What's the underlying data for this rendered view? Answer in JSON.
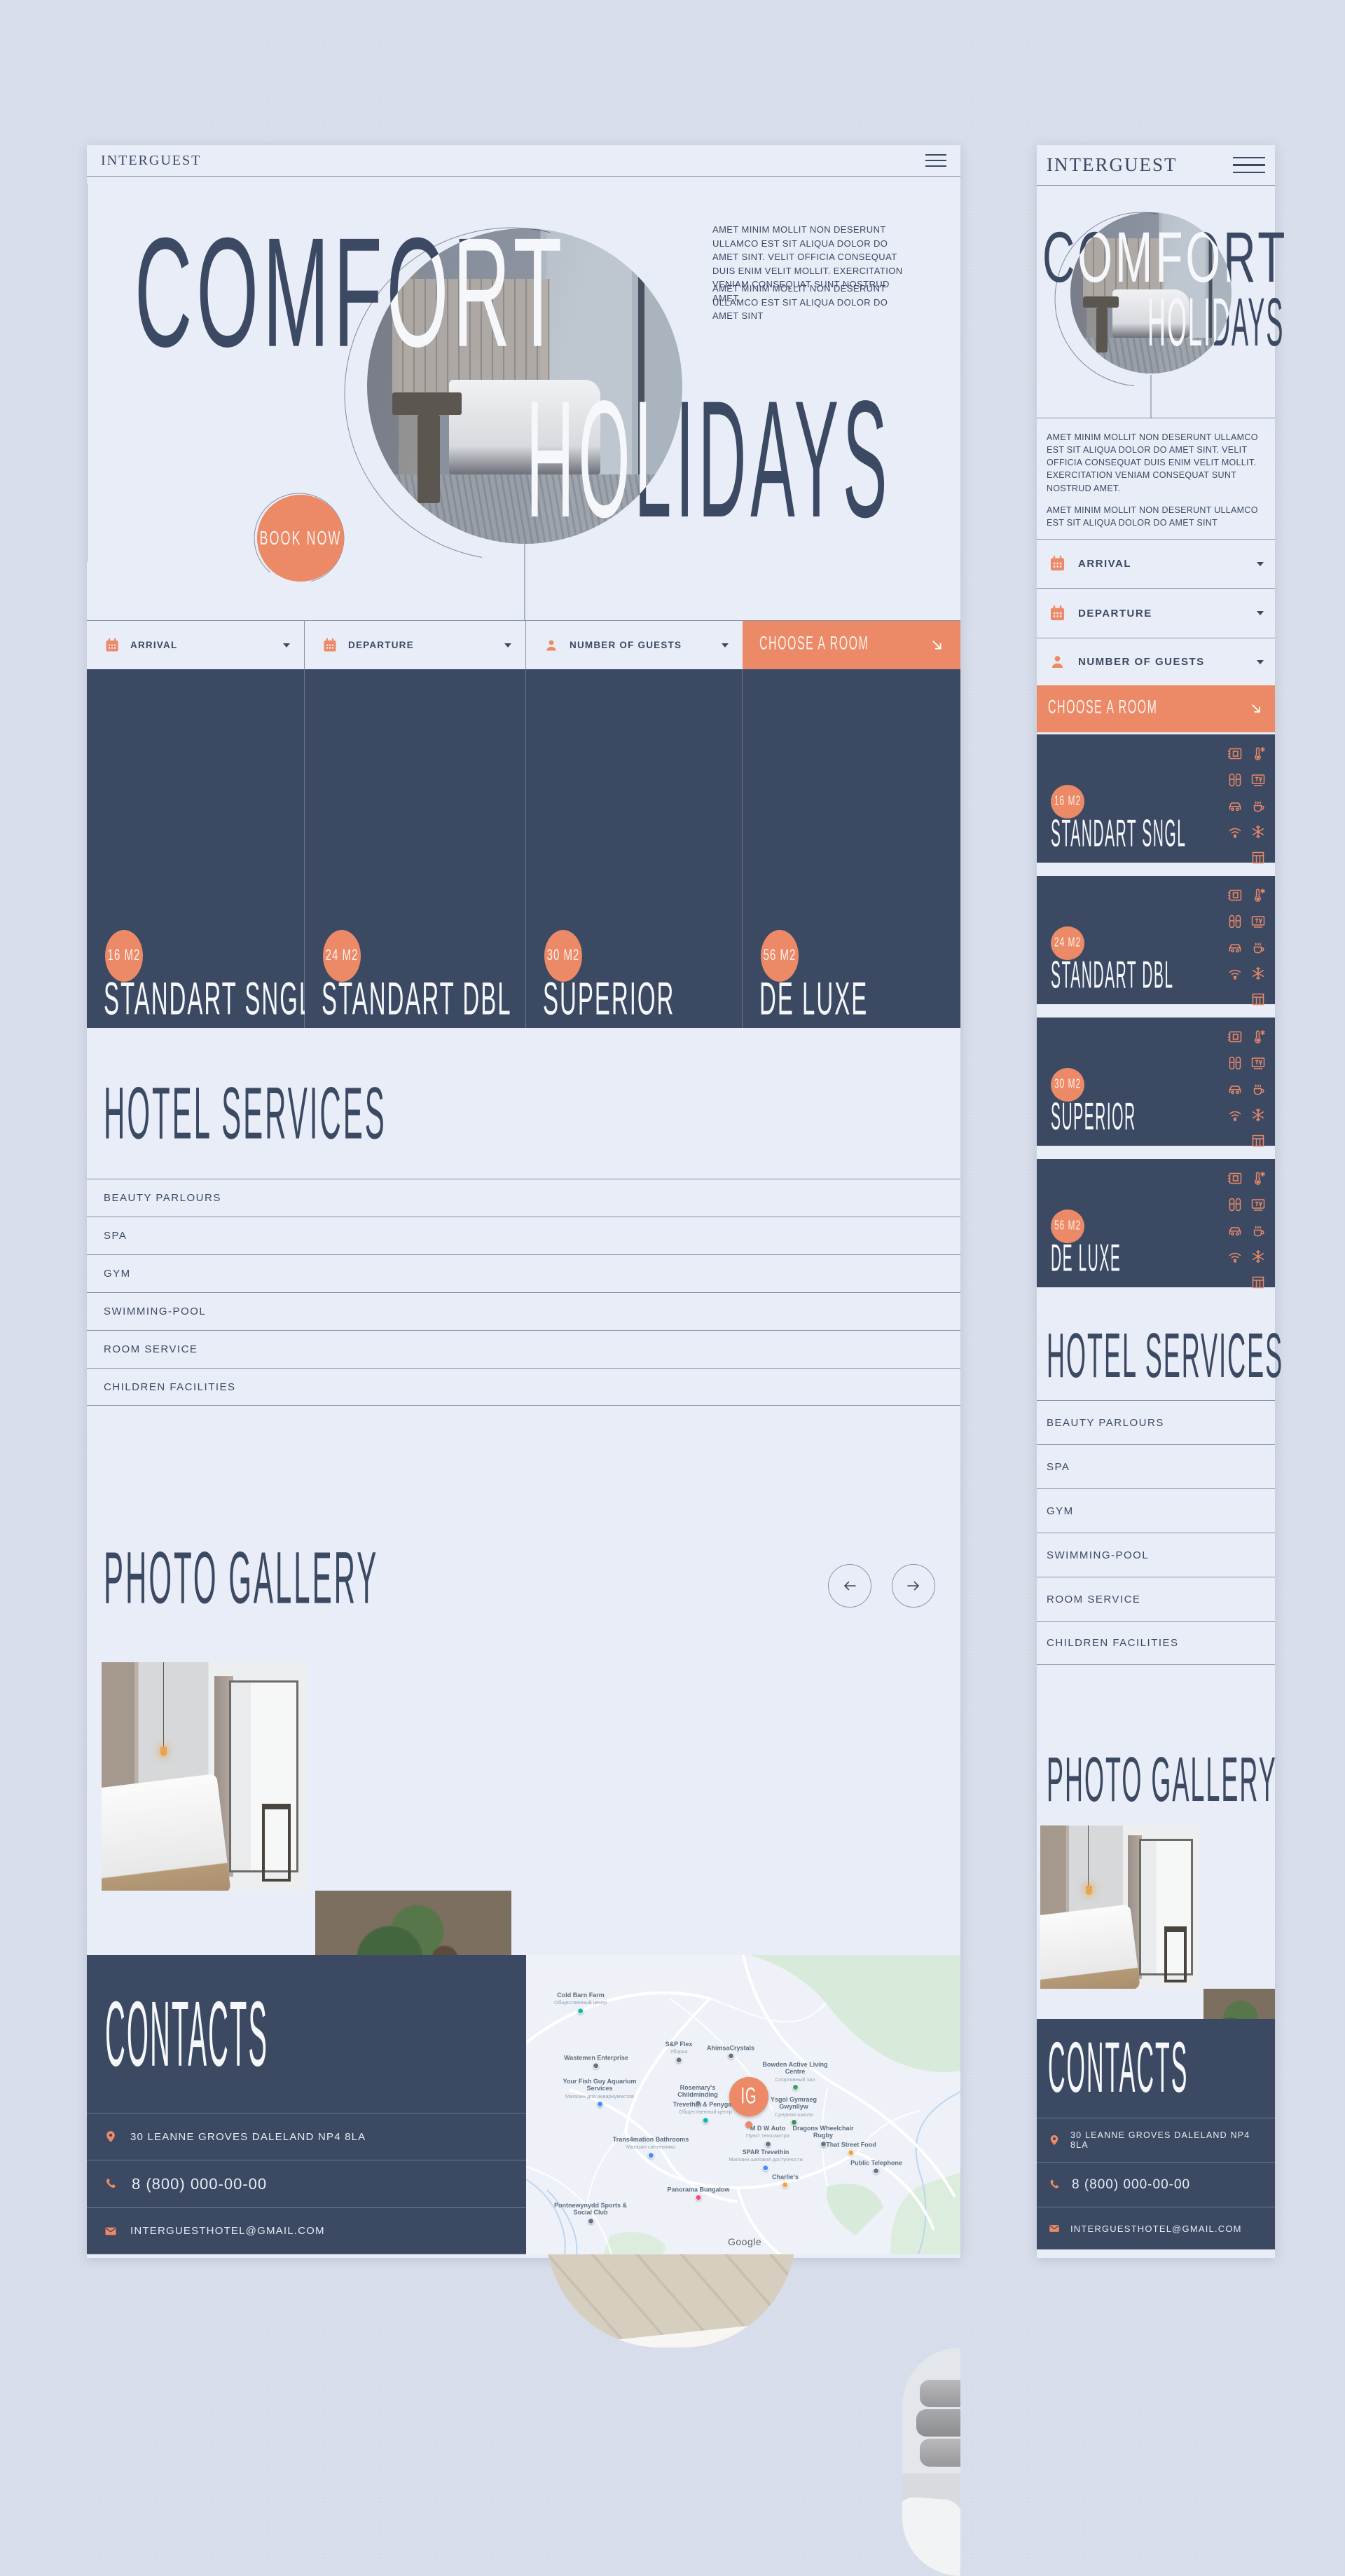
{
  "brand": "INTERGUEST",
  "hero": {
    "word1": "COMFORT",
    "word2": "HOLIDAYS",
    "cta": "BOOK NOW",
    "p1": "AMET MINIM MOLLIT NON DESERUNT ULLAMCO EST SIT ALIQUA DOLOR DO AMET SINT. VELIT OFFICIA CONSEQUAT DUIS ENIM VELIT MOLLIT. EXERCITATION VENIAM CONSEQUAT SUNT NOSTRUD AMET.",
    "p2": "AMET MINIM MOLLIT NON DESERUNT ULLAMCO EST SIT ALIQUA DOLOR DO AMET SINT"
  },
  "booking": {
    "arrival": "ARRIVAL",
    "departure": "DEPARTURE",
    "guests": "NUMBER OF GUESTS",
    "cta": "CHOOSE A ROOM"
  },
  "rooms": [
    {
      "size": "16 M2",
      "name": "STANDART SNGL"
    },
    {
      "size": "24 M2",
      "name": "STANDART DBL"
    },
    {
      "size": "30 M2",
      "name": "SUPERIOR"
    },
    {
      "size": "56 M2",
      "name": "DE LUXE"
    }
  ],
  "amenities": [
    "safe",
    "climate-control",
    "slippers",
    "tv",
    "parking",
    "coffee",
    "wifi",
    "air-conditioning",
    "blinds"
  ],
  "services": {
    "title": "HOTEL SERVICES",
    "items": [
      "BEAUTY PARLOURS",
      "SPA",
      "GYM",
      "SWIMMING-POOL",
      "ROOM SERVICE",
      "CHILDREN FACILITIES"
    ]
  },
  "gallery": {
    "title": "PHOTO GALLERY"
  },
  "contacts": {
    "title": "CONTACTS",
    "address": "30 LEANNE GROVES DALELAND NP4 8LA",
    "phone": "8 (800) 000-00-00",
    "email": "INTERGUESTHOTEL@GMAIL.COM"
  },
  "map": {
    "marker": "IG",
    "watermark": "Google",
    "labels": [
      {
        "text": "Cold Barn Farm",
        "sub": "Общественный центр"
      },
      {
        "text": "Wastemen Enterprise"
      },
      {
        "text": "Your Fish Guy Aquarium Services",
        "sub": "Магазин для аквариумистов"
      },
      {
        "text": "S&P Flex",
        "sub": "Уборка"
      },
      {
        "text": "AhimsaCrystals"
      },
      {
        "text": "Bowden Active Living Centre",
        "sub": "Спортивный зал"
      },
      {
        "text": "Rosemary's Childminding"
      },
      {
        "text": "Trevethin & Penygarn",
        "sub": "Общественный центр"
      },
      {
        "text": "Ysgol Gymraeg Gwynllyw",
        "sub": "Средняя школа"
      },
      {
        "text": "M D W Auto",
        "sub": "Пункт техосмотра"
      },
      {
        "text": "Dragons Wheelchair Rugby"
      },
      {
        "text": "That Street Food"
      },
      {
        "text": "SPAR Trevethin",
        "sub": "Магазин шаговой доступности"
      },
      {
        "text": "Public Telephone"
      },
      {
        "text": "Trans4mation Bathrooms",
        "sub": "Магазин сантехники"
      },
      {
        "text": "Panorama Bungalow"
      },
      {
        "text": "Charlie's"
      },
      {
        "text": "Pontnewynydd Sports & Social Club"
      }
    ]
  },
  "colors": {
    "navy": "#3b4963",
    "orange": "#ec8a67",
    "panel": "#e9edf8",
    "background": "#d7ddea"
  }
}
